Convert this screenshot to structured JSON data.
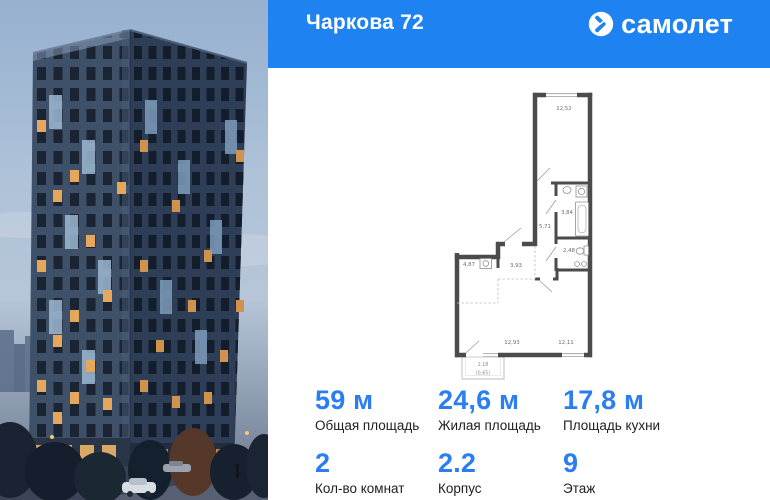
{
  "header": {
    "title": "Чаркова 72",
    "brand": "самолет"
  },
  "colors": {
    "accent": "#1e83f1",
    "stat_value_blue": "#2b7ef2",
    "plan_wall": "#4b4b4b"
  },
  "photo": {
    "description_icon": "building-render"
  },
  "plan": {
    "rooms": [
      {
        "name": "room-top",
        "area": "12,52"
      },
      {
        "name": "bathroom",
        "area": "3,84"
      },
      {
        "name": "corridor",
        "area": "5,71"
      },
      {
        "name": "wc",
        "area": "2,48"
      },
      {
        "name": "hallway",
        "area": "3,93"
      },
      {
        "name": "kitchen-zone",
        "area": "4,87"
      },
      {
        "name": "living-room",
        "area": "12,93"
      },
      {
        "name": "bedroom",
        "area": "12,11"
      }
    ],
    "balcony": {
      "area": "2,18",
      "coefficient_area": "(0,65)"
    }
  },
  "stats": {
    "row1": [
      {
        "value": "59 м",
        "label": "Общая площадь"
      },
      {
        "value": "24,6 м",
        "label": "Жилая площадь"
      },
      {
        "value": "17,8 м",
        "label": "Площадь кухни"
      }
    ],
    "row2": [
      {
        "value": "2",
        "label": "Кол-во комнат"
      },
      {
        "value": "2.2",
        "label": "Корпус"
      },
      {
        "value": "9",
        "label": "Этаж"
      }
    ]
  }
}
